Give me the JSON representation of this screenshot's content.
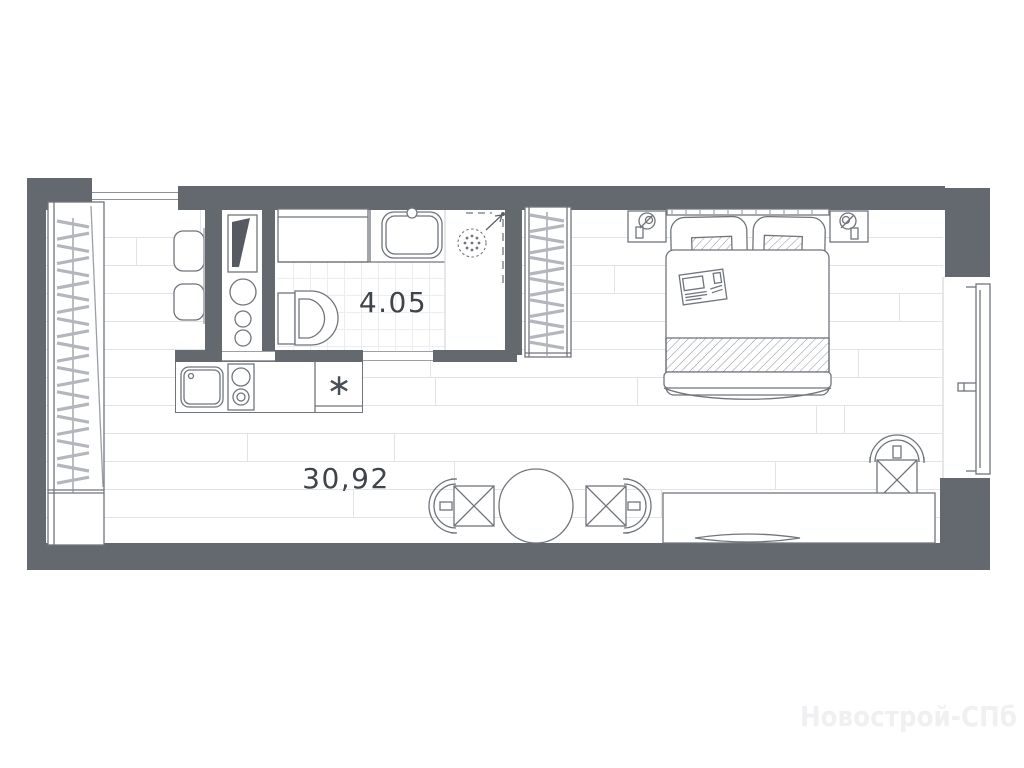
{
  "plan": {
    "bathroom": {
      "area_label": "4.05"
    },
    "living_room": {
      "area_label": "30,92"
    },
    "kitchen": {
      "fridge_symbol": "∗"
    },
    "watermark": "Новострой-СПб",
    "colors": {
      "wall": "#64686f",
      "outline": "#70757c",
      "outline_dark": "#5d6269",
      "floor_line": "#e1e3e6",
      "tile_line": "#ecedef",
      "label": "#3f434a",
      "watermark": "#f0f0f2"
    }
  }
}
